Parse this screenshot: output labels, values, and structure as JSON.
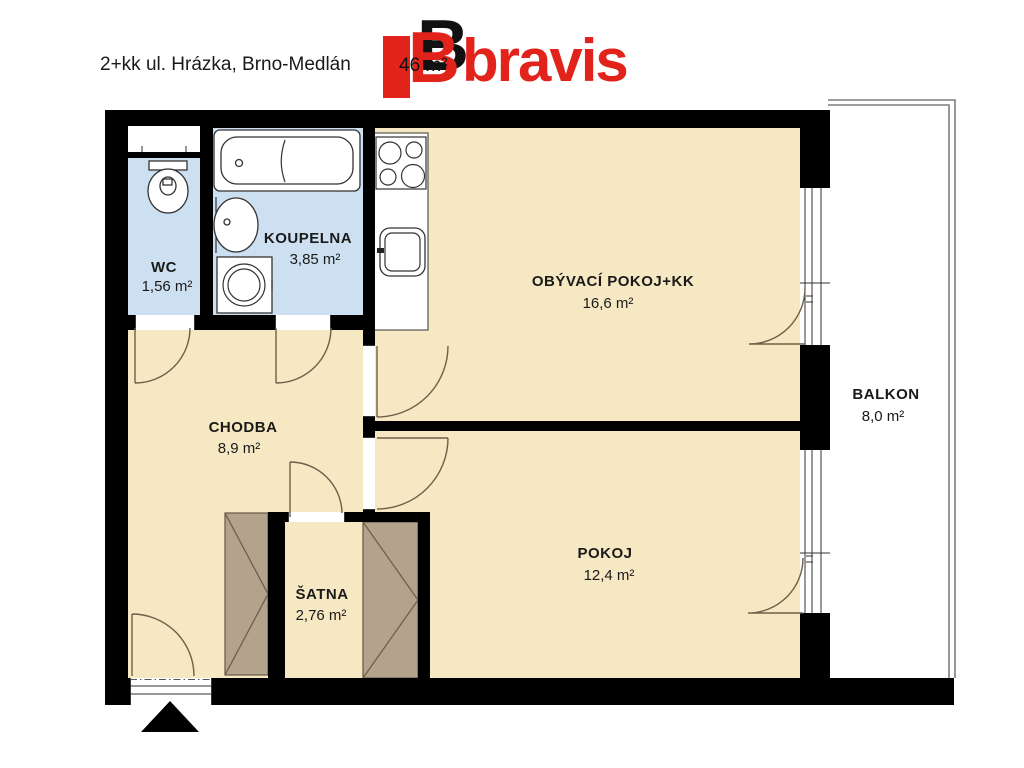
{
  "header": {
    "title": "2+kk ul. Hrázka, Brno-Medlán",
    "area_fragment": "46 m²",
    "logo": {
      "b_letter": "B",
      "wordmark": "bravis"
    }
  },
  "rooms": {
    "wc": {
      "name": "WC",
      "area": "1,56 m²"
    },
    "koupelna": {
      "name": "KOUPELNA",
      "area": "3,85 m²"
    },
    "chodba": {
      "name": "CHODBA",
      "area": "8,9 m²"
    },
    "obyvaci": {
      "name": "OBÝVACÍ POKOJ+KK",
      "area": "16,6 m²"
    },
    "pokoj": {
      "name": "POKOJ",
      "area": "12,4 m²"
    },
    "satna": {
      "name": "ŠATNA",
      "area": "2,76 m²"
    },
    "balkon": {
      "name": "BALKON",
      "area": "8,0 m²"
    }
  },
  "colors": {
    "room_cream": "#f6e8c3",
    "room_blue": "#cde0f2",
    "wardrobe": "#b3a28c",
    "wall": "#000000",
    "logo_red": "#e2231c"
  }
}
